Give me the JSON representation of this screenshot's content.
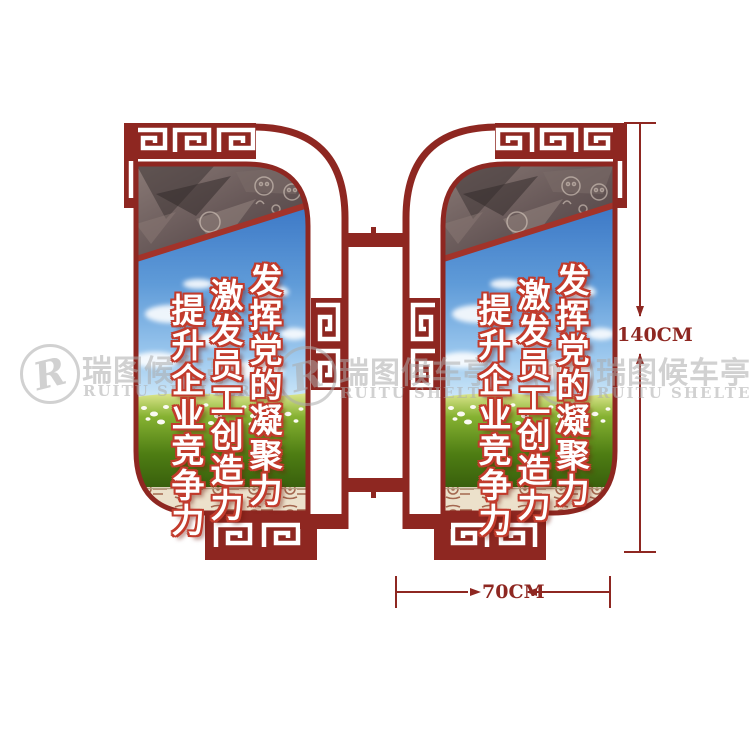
{
  "slogans": {
    "line1": "发挥党的凝聚力",
    "line2": "激发员工创造力",
    "line3": "提升企业竞争力"
  },
  "dimensions": {
    "height": "140CM",
    "width": "70CM"
  },
  "watermark": {
    "logo_letter": "R",
    "brand_cn": "瑞图候车亭",
    "brand_en": "RUITU SHELTER"
  },
  "colors": {
    "frame_red": "#8e2721",
    "slogan_outline_red": "#c23b2c",
    "sky_blue_top": "#2a66bd",
    "grass_green": "#4e7d13",
    "bottom_strip_beige": "#ece1cb",
    "motif_brown": "#9c5b42",
    "watermark_gray": "#acacac",
    "dimension_red": "#8e2721"
  }
}
